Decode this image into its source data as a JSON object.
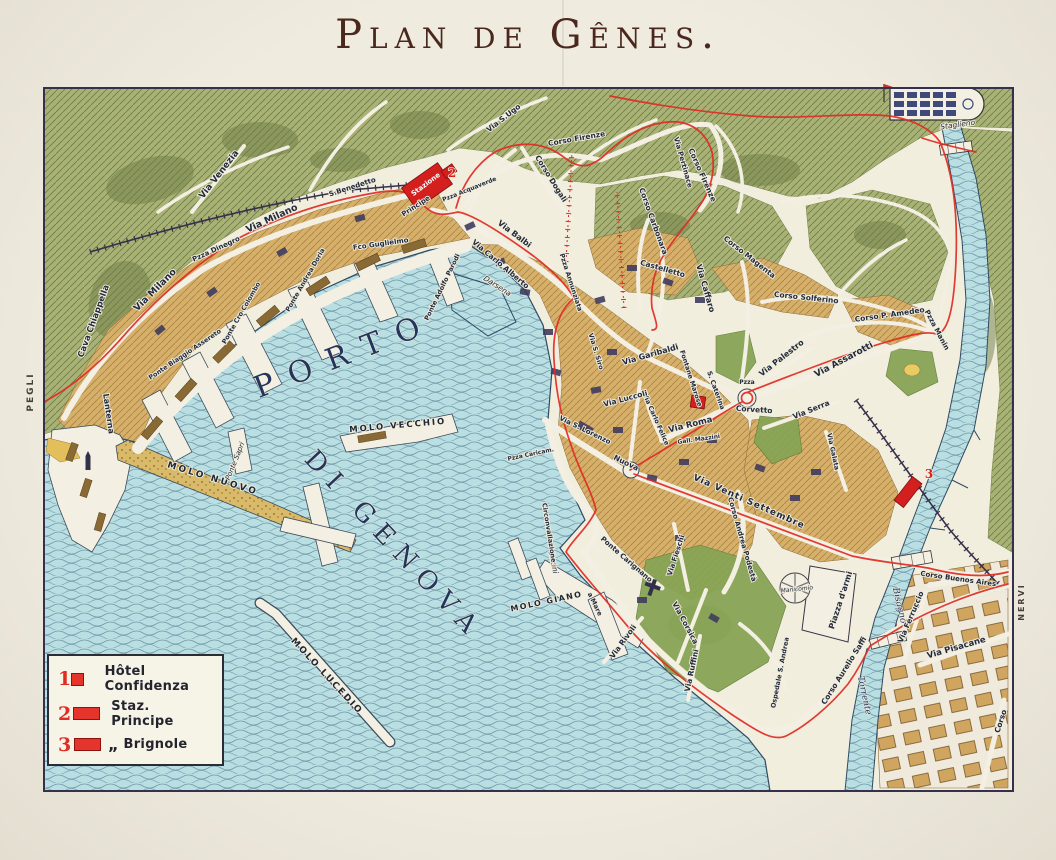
{
  "title": {
    "text": "Plan de Gênes."
  },
  "legend": {
    "items": [
      {
        "num": "1",
        "swatch": "sq",
        "ditto": "",
        "label": "Hôtel Confidenza"
      },
      {
        "num": "2",
        "swatch": "rc",
        "ditto": "",
        "label": "Staz. Principe"
      },
      {
        "num": "3",
        "swatch": "rc",
        "ditto": "„",
        "label": "Brignole"
      }
    ]
  },
  "colors": {
    "paper": "#efebdf",
    "sea": "#badfe3",
    "hills": "#a9b275",
    "city": "#d6af6b",
    "route_red": "#e12b24",
    "landmark_red": "#d41f1f",
    "ink": "#222a3c",
    "title": "#4a281e"
  },
  "map_labels": [
    {
      "id": "pegli",
      "t": "PEGLI",
      "x": 33,
      "y": 392,
      "r": -90,
      "s": 9,
      "c": "mg"
    },
    {
      "id": "nervi",
      "t": "NERVI",
      "x": 1024,
      "y": 602,
      "r": -90,
      "s": 8,
      "c": "mg"
    },
    {
      "id": "porto",
      "t": "PORTO",
      "x": 348,
      "y": 364,
      "r": -21,
      "s": 30,
      "c": "wb",
      "ls": 16
    },
    {
      "id": "di-genova",
      "t": "DI GENOVA",
      "x": 388,
      "y": 551,
      "r": 47,
      "s": 26,
      "c": "wb",
      "ls": 10
    },
    {
      "id": "torrente",
      "t": "Torrente",
      "x": 862,
      "y": 696,
      "r": 78,
      "s": 9,
      "c": "wi"
    },
    {
      "id": "bisagno",
      "t": "Bisagno",
      "x": 897,
      "y": 606,
      "r": 77,
      "s": 9,
      "c": "wi"
    },
    {
      "id": "molo-nuovo",
      "t": "MOLO NUOVO",
      "x": 212,
      "y": 481,
      "r": 17,
      "s": 9,
      "c": "mo",
      "ls": 2.5
    },
    {
      "id": "molo-vecchio",
      "t": "MOLO VECCHIO",
      "x": 398,
      "y": 428,
      "r": -5,
      "s": 8.5,
      "c": "mo",
      "ls": 2
    },
    {
      "id": "molo-giano",
      "t": "MOLO GIANO",
      "x": 547,
      "y": 604,
      "r": -12,
      "s": 8,
      "c": "mo",
      "ls": 1.5
    },
    {
      "id": "molo-lucedio",
      "t": "MOLO LUCEDIO",
      "x": 325,
      "y": 678,
      "r": 47,
      "s": 9,
      "c": "mo",
      "ls": 2
    },
    {
      "id": "ponte-sapri",
      "t": "Ponte Sapri",
      "x": 237,
      "y": 462,
      "r": -68,
      "s": 7,
      "c": "si"
    },
    {
      "id": "bacini",
      "t": "Bacini",
      "x": 551,
      "y": 563,
      "r": 78,
      "s": 7.5,
      "c": "si"
    },
    {
      "id": "darsena",
      "t": "Darsena",
      "x": 496,
      "y": 288,
      "r": 33,
      "s": 7.5,
      "c": "si"
    },
    {
      "id": "lanterna",
      "t": "Lanterna",
      "x": 106,
      "y": 414,
      "r": 82,
      "s": 8,
      "c": "st"
    },
    {
      "id": "ponte-parodi",
      "t": "Ponte Adolfo Parodi",
      "x": 444,
      "y": 288,
      "r": -64,
      "s": 6.5,
      "c": "st"
    },
    {
      "id": "fco-guglielmo",
      "t": "Fco Guglielmo",
      "x": 381,
      "y": 246,
      "r": -8,
      "s": 7,
      "c": "st"
    },
    {
      "id": "ponte-assereto",
      "t": "Ponte Biaggio Assereto",
      "x": 186,
      "y": 356,
      "r": -34,
      "s": 6.5,
      "c": "st"
    },
    {
      "id": "ponte-colombo",
      "t": "Ponte Cro Colombo",
      "x": 243,
      "y": 314,
      "r": -60,
      "s": 6.5,
      "c": "st"
    },
    {
      "id": "ponte-doria",
      "t": "Ponte Andrea Doria",
      "x": 307,
      "y": 281,
      "r": -60,
      "s": 6.5,
      "c": "st"
    },
    {
      "id": "pzza-dinegro",
      "t": "Pzza Dinegro",
      "x": 217,
      "y": 251,
      "r": -25,
      "s": 7,
      "c": "st"
    },
    {
      "id": "via-venezia",
      "t": "Via Venezia",
      "x": 221,
      "y": 176,
      "r": -52,
      "s": 9,
      "c": "st"
    },
    {
      "id": "via-milano-1",
      "t": "Via Milano",
      "x": 273,
      "y": 221,
      "r": -25,
      "s": 9.5,
      "c": "st"
    },
    {
      "id": "via-milano-2",
      "t": "Via Milano",
      "x": 157,
      "y": 292,
      "r": -45,
      "s": 9.5,
      "c": "st"
    },
    {
      "id": "cava-chiappella",
      "t": "Cava Chiappella",
      "x": 96,
      "y": 322,
      "r": -70,
      "s": 8.5,
      "c": "st"
    },
    {
      "id": "s-benedetto",
      "t": "S.Benedetto",
      "x": 353,
      "y": 189,
      "r": -18,
      "s": 7,
      "c": "st"
    },
    {
      "id": "via-s-ugo",
      "t": "Via S.Ugo",
      "x": 505,
      "y": 120,
      "r": -38,
      "s": 7.5,
      "c": "st"
    },
    {
      "id": "corso-firenze-1",
      "t": "Corso Firenze",
      "x": 577,
      "y": 141,
      "r": -10,
      "s": 7.5,
      "c": "st"
    },
    {
      "id": "corso-firenze-2",
      "t": "Corso Firenze",
      "x": 700,
      "y": 176,
      "r": 66,
      "s": 7.5,
      "c": "st"
    },
    {
      "id": "via-pertinace",
      "t": "Via Pertinace",
      "x": 681,
      "y": 163,
      "r": 74,
      "s": 7,
      "c": "st"
    },
    {
      "id": "corso-dogali",
      "t": "Corso Dogali",
      "x": 549,
      "y": 180,
      "r": 58,
      "s": 7.5,
      "c": "st"
    },
    {
      "id": "stazione",
      "t": "Stazione",
      "x": 427,
      "y": 186,
      "r": -37,
      "s": 7,
      "c": "wt"
    },
    {
      "id": "principe",
      "t": "Principe",
      "x": 417,
      "y": 208,
      "r": -33,
      "s": 7,
      "c": "st"
    },
    {
      "id": "pzza-acquaverde",
      "t": "Pzza Acquaverde",
      "x": 470,
      "y": 191,
      "r": -22,
      "s": 6,
      "c": "st"
    },
    {
      "id": "via-balbi",
      "t": "Via Balbi",
      "x": 513,
      "y": 236,
      "r": 37,
      "s": 8,
      "c": "st"
    },
    {
      "id": "via-carlo-alberto",
      "t": "Via Carlo Alberto",
      "x": 499,
      "y": 266,
      "r": 40,
      "s": 7.5,
      "c": "st"
    },
    {
      "id": "pzza-annunziata",
      "t": "Pzza Annunziata",
      "x": 569,
      "y": 283,
      "r": 72,
      "s": 6.5,
      "c": "st"
    },
    {
      "id": "corso-carbonara",
      "t": "Corso Carbonara",
      "x": 651,
      "y": 222,
      "r": 70,
      "s": 7.5,
      "c": "st"
    },
    {
      "id": "castelletto",
      "t": "Castelletto",
      "x": 662,
      "y": 271,
      "r": 16,
      "s": 7.5,
      "c": "st"
    },
    {
      "id": "via-caffaro",
      "t": "Via Caffaro",
      "x": 703,
      "y": 289,
      "r": 74,
      "s": 8,
      "c": "st"
    },
    {
      "id": "corso-magenta",
      "t": "Corso Magenta",
      "x": 748,
      "y": 259,
      "r": 38,
      "s": 7.5,
      "c": "st"
    },
    {
      "id": "corso-solferino",
      "t": "Corso Solferino",
      "x": 806,
      "y": 300,
      "r": 6,
      "s": 7.5,
      "c": "st"
    },
    {
      "id": "corso-p-amedeo",
      "t": "Corso P. Amedeo",
      "x": 890,
      "y": 317,
      "r": -8,
      "s": 7.5,
      "c": "st"
    },
    {
      "id": "pzza-manin",
      "t": "Pzza Manin",
      "x": 935,
      "y": 331,
      "r": 62,
      "s": 7,
      "c": "st"
    },
    {
      "id": "via-assarotti",
      "t": "Via Assarotti",
      "x": 845,
      "y": 362,
      "r": -28,
      "s": 9,
      "c": "st"
    },
    {
      "id": "via-palestro",
      "t": "Via Palestro",
      "x": 783,
      "y": 360,
      "r": -38,
      "s": 8,
      "c": "st"
    },
    {
      "id": "via-serra",
      "t": "Via Serra",
      "x": 812,
      "y": 412,
      "r": -22,
      "s": 7.5,
      "c": "st"
    },
    {
      "id": "via-garibaldi",
      "t": "Via Garibaldi",
      "x": 651,
      "y": 357,
      "r": -16,
      "s": 8,
      "c": "st"
    },
    {
      "id": "fontane-marose",
      "t": "Fontane Marose",
      "x": 689,
      "y": 379,
      "r": 72,
      "s": 6.5,
      "c": "st"
    },
    {
      "id": "salita-s-caterina",
      "t": "S. Caterina",
      "x": 714,
      "y": 391,
      "r": 70,
      "s": 6.5,
      "c": "st"
    },
    {
      "id": "pzza-corvetto",
      "t": "Pzza",
      "x": 747,
      "y": 384,
      "r": 0,
      "s": 6,
      "c": "st"
    },
    {
      "id": "corvetto",
      "t": "Corvetto",
      "x": 754,
      "y": 412,
      "r": 4,
      "s": 7.5,
      "c": "st"
    },
    {
      "id": "via-roma",
      "t": "Via Roma",
      "x": 691,
      "y": 427,
      "r": -14,
      "s": 8.5,
      "c": "st"
    },
    {
      "id": "via-carlo-felice",
      "t": "Via Carlo Felice",
      "x": 654,
      "y": 420,
      "r": 66,
      "s": 6.5,
      "c": "st"
    },
    {
      "id": "via-luccoli",
      "t": "Via Luccoli",
      "x": 626,
      "y": 401,
      "r": -15,
      "s": 7.5,
      "c": "st"
    },
    {
      "id": "via-s-siro",
      "t": "Via S. Siro",
      "x": 594,
      "y": 352,
      "r": 73,
      "s": 6.5,
      "c": "st"
    },
    {
      "id": "gall-mazzini",
      "t": "Gall. Mazzini",
      "x": 699,
      "y": 441,
      "r": -8,
      "s": 6,
      "c": "st"
    },
    {
      "id": "via-s-lorenzo",
      "t": "Via S. Lorenzo",
      "x": 584,
      "y": 432,
      "r": 26,
      "s": 7,
      "c": "st"
    },
    {
      "id": "nuova",
      "t": "Nuova",
      "x": 625,
      "y": 465,
      "r": 26,
      "s": 7.5,
      "c": "st"
    },
    {
      "id": "pzza-caricamento",
      "t": "Pzza Caricam.",
      "x": 531,
      "y": 456,
      "r": -12,
      "s": 6,
      "c": "st"
    },
    {
      "id": "circonvallazione",
      "t": "Circonvallazione",
      "x": 547,
      "y": 533,
      "r": 81,
      "s": 6.5,
      "c": "st"
    },
    {
      "id": "a-mare",
      "t": "a Mare",
      "x": 593,
      "y": 605,
      "r": 64,
      "s": 6.5,
      "c": "st"
    },
    {
      "id": "via-venti-settembre",
      "t": "Via Venti Settembre",
      "x": 748,
      "y": 504,
      "r": 24,
      "s": 9,
      "c": "st",
      "ls": 1
    },
    {
      "id": "corso-podesta",
      "t": "Corso Andrea Podestà",
      "x": 740,
      "y": 540,
      "r": 74,
      "s": 7,
      "c": "st"
    },
    {
      "id": "ponte-carignano",
      "t": "Ponte Carignano",
      "x": 625,
      "y": 561,
      "r": 41,
      "s": 7,
      "c": "st"
    },
    {
      "id": "via-fieschi",
      "t": "Via Fieschi",
      "x": 678,
      "y": 556,
      "r": -72,
      "s": 7,
      "c": "st"
    },
    {
      "id": "via-rivoli",
      "t": "Via Rivoli",
      "x": 625,
      "y": 643,
      "r": -54,
      "s": 7.5,
      "c": "st"
    },
    {
      "id": "via-corsica",
      "t": "Via Corsica",
      "x": 683,
      "y": 624,
      "r": 62,
      "s": 7.5,
      "c": "st"
    },
    {
      "id": "via-ruffini",
      "t": "Via Ruffini",
      "x": 694,
      "y": 671,
      "r": -78,
      "s": 7.5,
      "c": "st"
    },
    {
      "id": "ospedale-s-andrea",
      "t": "Ospedale S. Andrea",
      "x": 782,
      "y": 673,
      "r": -79,
      "s": 6.5,
      "c": "st"
    },
    {
      "id": "manicomio",
      "t": "Manicomio",
      "x": 797,
      "y": 591,
      "r": -6,
      "s": 6,
      "c": "si"
    },
    {
      "id": "piazza-darmi",
      "t": "Piazza d'armi",
      "x": 843,
      "y": 601,
      "r": -72,
      "s": 8,
      "c": "st"
    },
    {
      "id": "corso-aurelio-saffi",
      "t": "Corso Aurelio Saffi",
      "x": 846,
      "y": 672,
      "r": -58,
      "s": 7.5,
      "c": "st"
    },
    {
      "id": "via-ferruccio",
      "t": "Via Ferruccio",
      "x": 913,
      "y": 618,
      "r": -67,
      "s": 7.5,
      "c": "st"
    },
    {
      "id": "via-pisacane",
      "t": "Via Pisacane",
      "x": 957,
      "y": 650,
      "r": -16,
      "s": 8.5,
      "c": "st"
    },
    {
      "id": "corso-buenos-aires",
      "t": "Corso Buenos Aires",
      "x": 958,
      "y": 581,
      "r": 8,
      "s": 7,
      "c": "st"
    },
    {
      "id": "corso-foce",
      "t": "Corso",
      "x": 1003,
      "y": 722,
      "r": -72,
      "s": 7.5,
      "c": "st"
    },
    {
      "id": "via-galata",
      "t": "Via Galata",
      "x": 831,
      "y": 452,
      "r": 78,
      "s": 6.5,
      "c": "st"
    },
    {
      "id": "staglieno",
      "t": "Staglieno",
      "x": 958,
      "y": 127,
      "r": -8,
      "s": 7.5,
      "c": "si"
    },
    {
      "id": "marker-2",
      "t": "2",
      "x": 452,
      "y": 177,
      "r": 0,
      "s": 12,
      "c": "rd"
    },
    {
      "id": "marker-3",
      "t": "3",
      "x": 929,
      "y": 478,
      "r": 0,
      "s": 12,
      "c": "rd"
    }
  ]
}
